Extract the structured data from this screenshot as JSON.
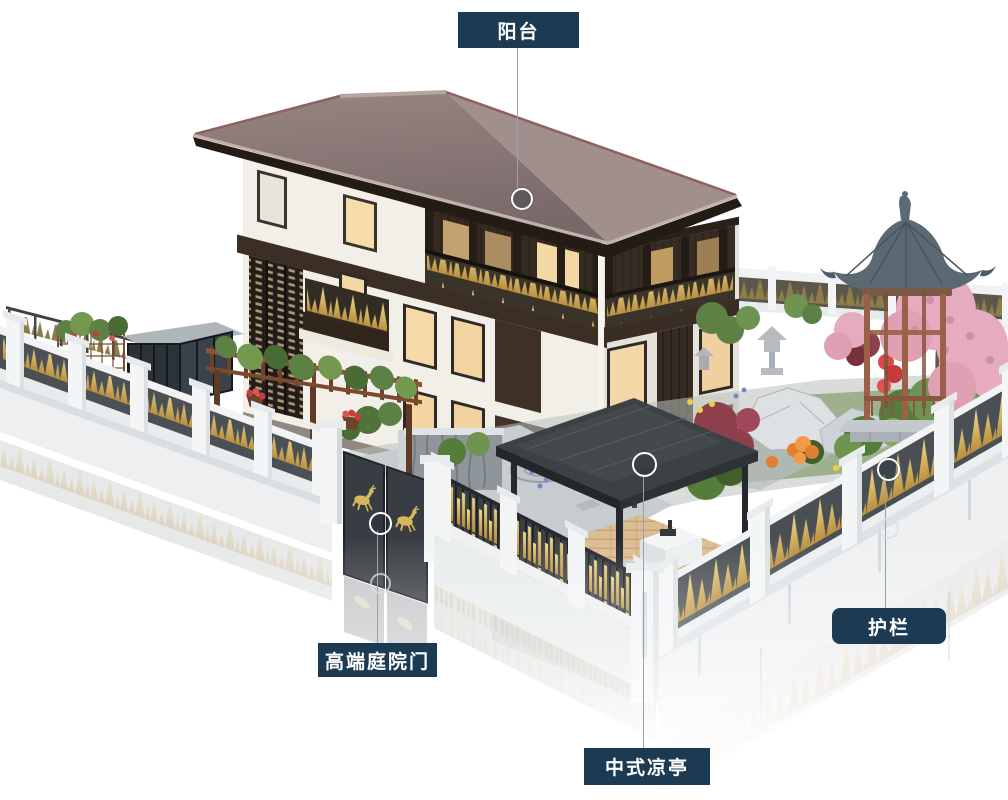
{
  "scene": {
    "background_color": "#ffffff"
  },
  "callouts": [
    {
      "id": "balcony",
      "label": "阳台"
    },
    {
      "id": "courtyard-gate",
      "label": "高端庭院门"
    },
    {
      "id": "pavilion",
      "label": "中式凉亭"
    },
    {
      "id": "guardrail",
      "label": "护栏"
    }
  ],
  "colors": {
    "label_background": "#1d3a53",
    "label_text": "#ffffff",
    "callout_line": "#9aa1a7",
    "marker_ring": "#ffffff",
    "fence_gold": "#d8b959",
    "fence_panel": "#4b5055",
    "fence_white": "#f2f4f5",
    "roof": "#8d7b79",
    "gazebo_roof": "#5b6973",
    "wood": "#8a5639",
    "blossom_pink": "#e5abbe",
    "foliage_green": "#557c3a",
    "window_glow": "#f3d7a6"
  }
}
